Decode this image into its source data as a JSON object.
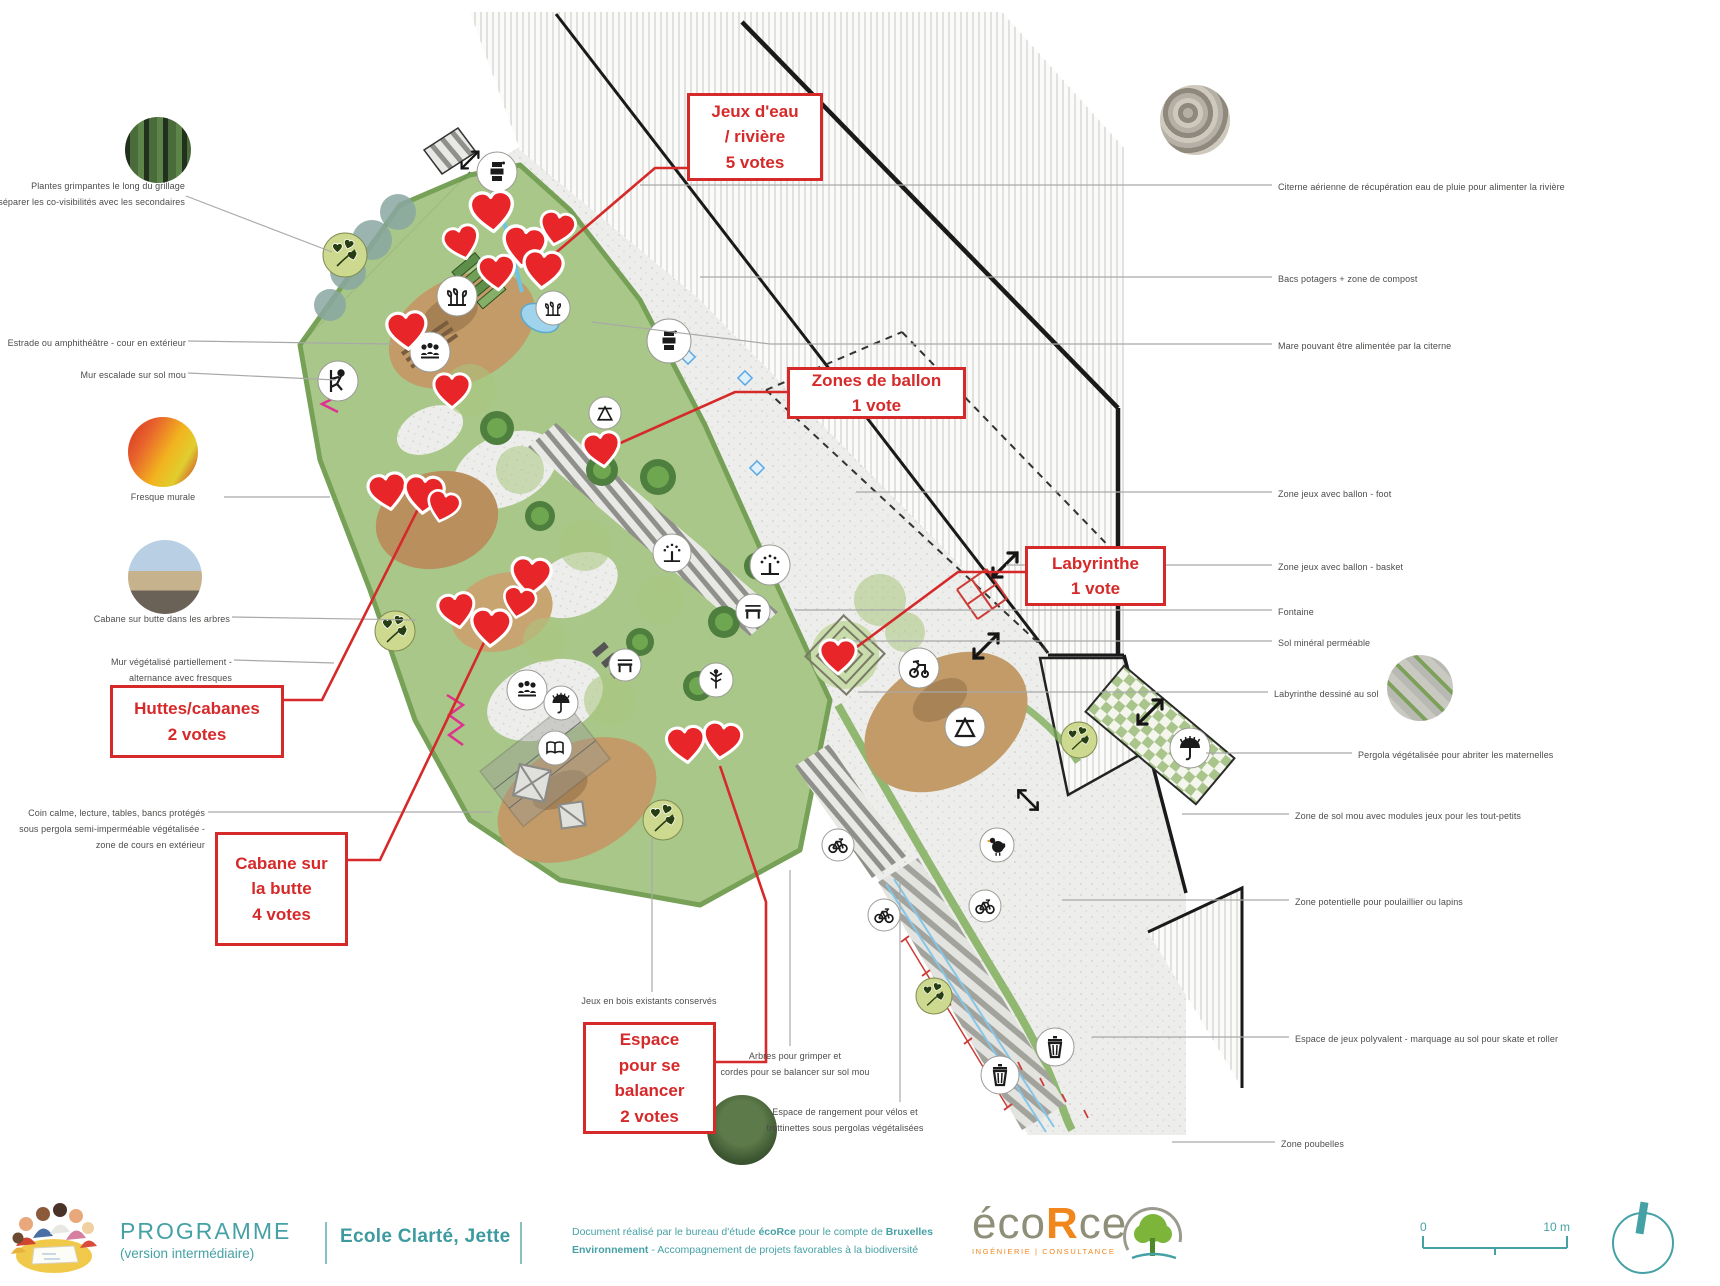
{
  "labels_left": [
    {
      "text": "Plantes grimpantes le long du grillage\npour séparer les co-visibilités avec les secondaires"
    },
    {
      "text": "Estrade ou amphithéâtre - cour en extérieur"
    },
    {
      "text": "Mur escalade sur sol mou"
    },
    {
      "text": "Fresque murale"
    },
    {
      "text": "Cabane sur butte dans les arbres"
    },
    {
      "text": "Mur végétalisé partiellement -\nalternance avec fresques"
    },
    {
      "text": "Coin calme, lecture, tables, bancs protégés\nsous pergola semi-imperméable végétalisée -\nzone de cours en extérieur"
    },
    {
      "text": "Jeux en bois existants conservés"
    },
    {
      "text": "Arbres pour grimper et\ncordes pour se balancer sur sol mou"
    },
    {
      "text": "Espace de rangement pour vélos et\ntrottinettes sous pergolas végétalisées"
    }
  ],
  "labels_right": [
    {
      "text": "Citerne aérienne de récupération eau de pluie pour alimenter la rivière"
    },
    {
      "text": "Bacs potagers + zone de compost"
    },
    {
      "text": "Mare pouvant être alimentée par la citerne"
    },
    {
      "text": "Zone jeux avec ballon - foot"
    },
    {
      "text": "Zone jeux avec ballon - basket"
    },
    {
      "text": "Fontaine"
    },
    {
      "text": "Sol minéral perméable"
    },
    {
      "text": "Labyrinthe dessiné au sol"
    },
    {
      "text": "Pergola végétalisée pour abriter les maternelles"
    },
    {
      "text": "Zone de sol mou avec modules jeux pour les tout-petits"
    },
    {
      "text": "Zone potentielle pour poulaillier ou lapins"
    },
    {
      "text": "Espace de jeux polyvalent - marquage au sol pour skate et roller"
    },
    {
      "text": "Zone poubelles"
    }
  ],
  "vote_boxes": [
    {
      "text": "Jeux d'eau\n/ rivière\n5 votes"
    },
    {
      "text": "Zones de ballon\n1 vote"
    },
    {
      "text": "Labyrinthe\n1 vote"
    },
    {
      "text": "Huttes/cabanes\n2 votes"
    },
    {
      "text": "Cabane sur\nla butte\n4 votes"
    },
    {
      "text": "Espace\npour se\nbalancer\n2 votes"
    }
  ],
  "footer": {
    "program_title": "PROGRAMME",
    "program_subtitle": "(version intermédiaire)",
    "project_name": "Ecole Clarté, Jette",
    "credit": {
      "c1": "Document réalisé par le bureau d'étude ",
      "c2": "écoRce",
      "c3": " pour le compte de ",
      "c4": "Bruxelles",
      "c5": "Environnement",
      "c6": " - Accompagnement de projets favorables à la biodiversité"
    },
    "logo": {
      "eco": "éco",
      "r": "R",
      "ce": "ce",
      "tagline": "INGÉNIERIE | CONSULTANCE"
    }
  },
  "scale": {
    "zero": "0",
    "ten": "10 m"
  },
  "colors": {
    "annotation_red": "#d6292a",
    "heart_red": "#e8262a",
    "teal": "#45a1a5",
    "orange": "#f0861c",
    "olive_badge": "#cdd98e"
  },
  "icon_names": [
    "vote-heart-icon",
    "vegetation-zone-icon",
    "water-pump-icon",
    "vegetable-rows-icon",
    "people-gathering-icon",
    "climbing-icon",
    "fountain-icon",
    "umbrella-pergola-icon",
    "bench-icon",
    "book-icon",
    "tree-climbing-icon",
    "play-structure-icon",
    "tricycle-icon",
    "bike-icon",
    "chicken-icon",
    "trash-icon",
    "double-arrow-icon",
    "north-arrow-icon"
  ]
}
